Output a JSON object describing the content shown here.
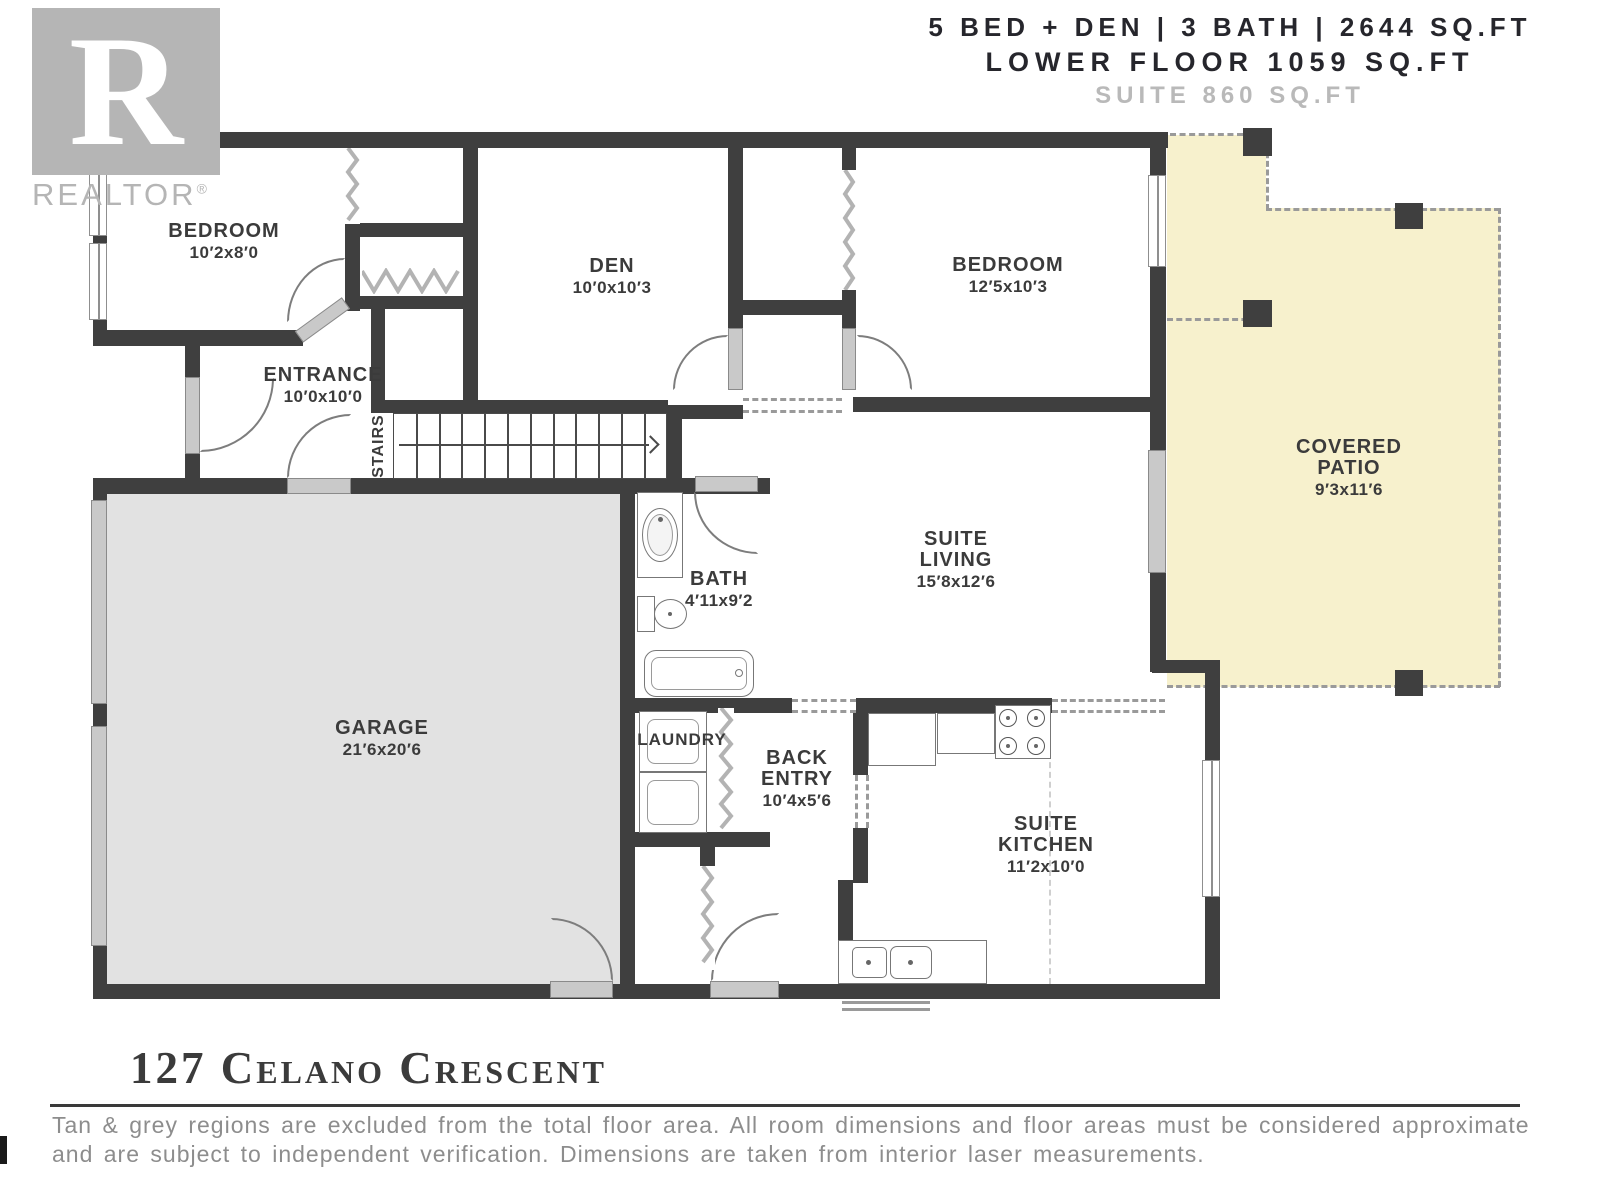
{
  "header": {
    "line1": "5 BED + DEN | 3 BATH | 2644 SQ.FT",
    "line2": "LOWER FLOOR 1059 SQ.FT",
    "line3": "SUITE 860 SQ.FT"
  },
  "logo": {
    "letter": "R",
    "brand": "REALTOR",
    "registered": "®"
  },
  "rooms": {
    "bedroom1": {
      "lines": [
        "BEDROOM",
        "10′2x8′0"
      ]
    },
    "den": {
      "lines": [
        "DEN",
        "10′0x10′3"
      ]
    },
    "bedroom2": {
      "lines": [
        "BEDROOM",
        "12′5x10′3"
      ]
    },
    "entrance": {
      "lines": [
        "ENTRANCE",
        "10′0x10′0"
      ]
    },
    "stairs": {
      "label": "STAIRS"
    },
    "garage": {
      "lines": [
        "GARAGE",
        "21′6x20′6"
      ]
    },
    "bath": {
      "lines": [
        "BATH",
        "4′11x9′2"
      ]
    },
    "suite_living": {
      "lines": [
        "SUITE",
        "LIVING",
        "15′8x12′6"
      ]
    },
    "covered_patio": {
      "lines": [
        "COVERED",
        "PATIO",
        "9′3x11′6"
      ]
    },
    "laundry": {
      "lines": [
        "LAUNDRY"
      ]
    },
    "back_entry": {
      "lines": [
        "BACK",
        "ENTRY",
        "10′4x5′6"
      ]
    },
    "suite_kitchen": {
      "lines": [
        "SUITE",
        "KITCHEN",
        "11′2x10′0"
      ]
    }
  },
  "footer": {
    "address": "127 Celano Crescent",
    "disclaimer_line1": "Tan & grey regions are excluded from the total floor area. All room dimensions and floor areas must be considered approximate",
    "disclaimer_line2": "and are subject to independent verification. Dimensions are taken from interior laser measurements."
  },
  "colors": {
    "wall": "#3f3f3f",
    "garage_fill": "#e2e2e2",
    "patio_fill": "#f7f1cd",
    "accent_grey": "#b5b5b5",
    "label": "#3b3b3b"
  }
}
